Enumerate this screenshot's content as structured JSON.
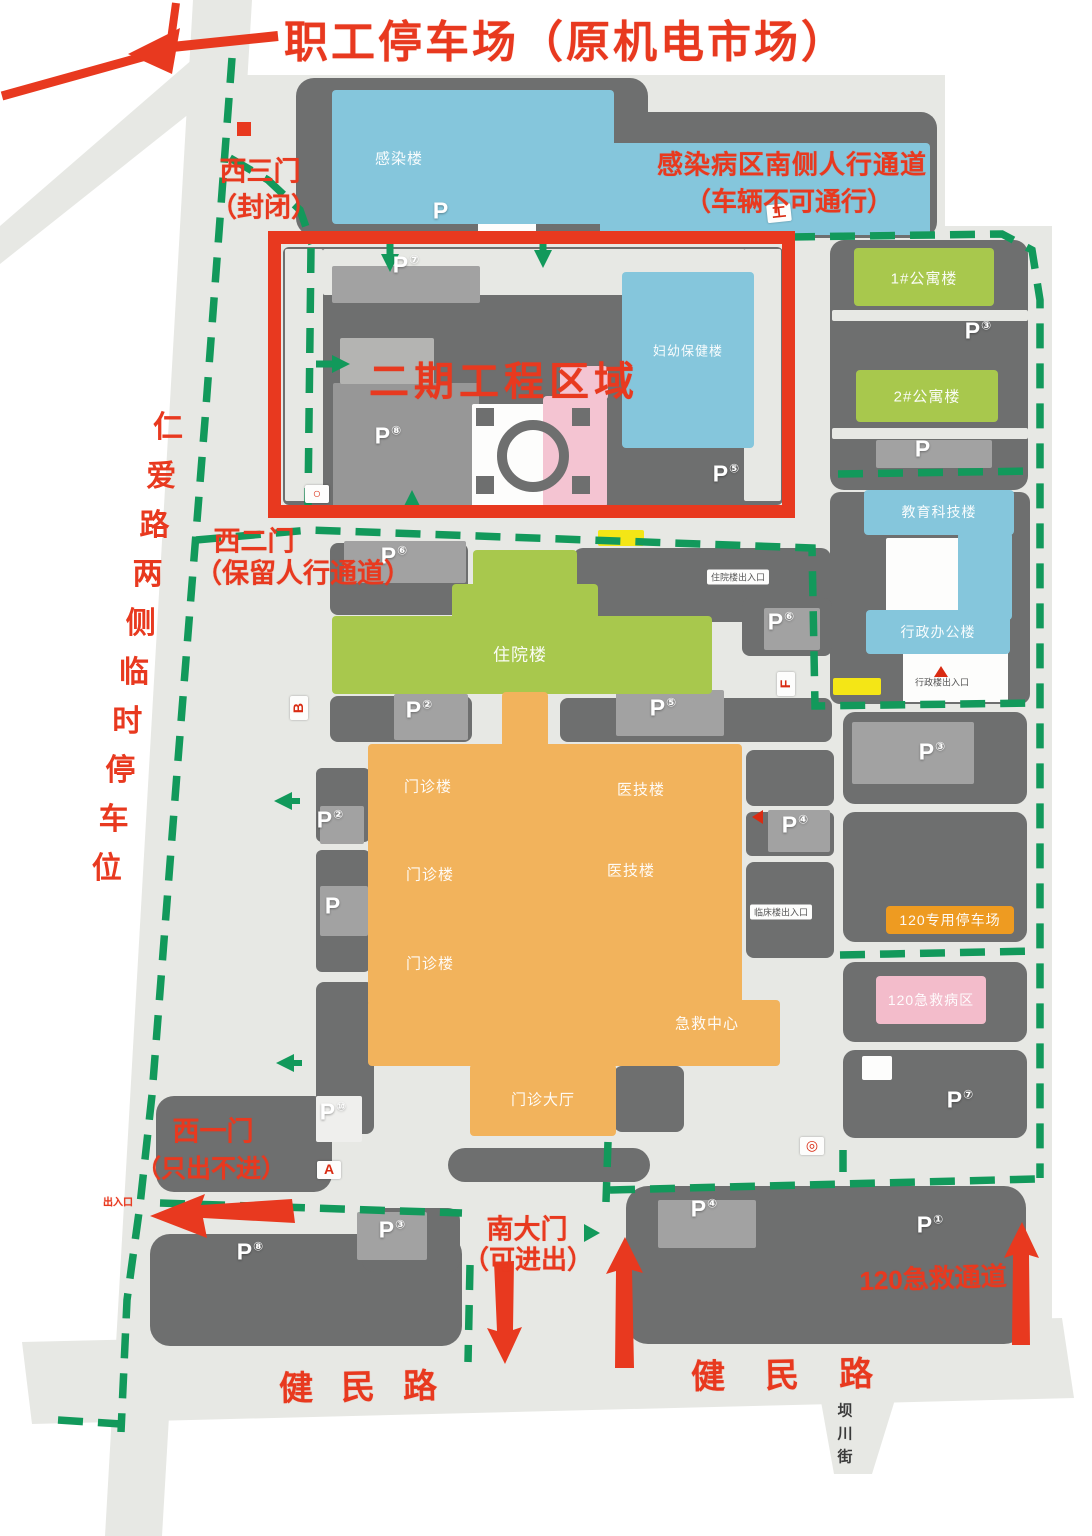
{
  "ui": {
    "parking_letter": "P"
  },
  "colors": {
    "accent_red": "#e8391f",
    "route_green": "#12995b",
    "ground": "#e7e8e4",
    "block": "#6e6f6f",
    "blue": "#85c6dc",
    "green": "#a8c84d",
    "orange": "#f2b35c",
    "pink": "#f4c4d2",
    "pink2": "#f3bccb",
    "banner": "#ee9b21",
    "yellow": "#f4e616"
  },
  "annotations": [
    {
      "id": "staff-parking-title",
      "text": "职工停车场（原机电市场）",
      "x": 566,
      "y": 38,
      "size": 44,
      "ls": 3
    },
    {
      "id": "infection-note-line1",
      "text": "感染病区南侧人行通道",
      "x": 792,
      "y": 163,
      "size": 26,
      "ls": 1
    },
    {
      "id": "infection-note-line2",
      "text": "（车辆不可通行）",
      "x": 789,
      "y": 200,
      "size": 26
    },
    {
      "id": "west-gate-3",
      "text": "西三门",
      "x": 260,
      "y": 169,
      "size": 27
    },
    {
      "id": "west-gate-3-note",
      "text": "（封闭）",
      "x": 264,
      "y": 205,
      "size": 27
    },
    {
      "id": "west-gate-2",
      "text": "西二门",
      "x": 254,
      "y": 539,
      "size": 27
    },
    {
      "id": "west-gate-2-note",
      "text": "（保留人行通道）",
      "x": 303,
      "y": 571,
      "size": 27
    },
    {
      "id": "phase2-zone-label",
      "text": "二期工程区域",
      "x": 504,
      "y": 378,
      "size": 40,
      "ls": 5
    },
    {
      "id": "west-gate-1",
      "text": "西一门",
      "x": 213,
      "y": 1129,
      "size": 27
    },
    {
      "id": "west-gate-1-note",
      "text": "（只出不进）",
      "x": 211,
      "y": 1167,
      "size": 25
    },
    {
      "id": "south-gate",
      "text": "南大门",
      "x": 527,
      "y": 1227,
      "size": 27
    },
    {
      "id": "south-gate-note",
      "text": "（可进出）",
      "x": 528,
      "y": 1258,
      "size": 26
    },
    {
      "id": "emergency-route-label",
      "text": "120急救通道",
      "x": 933,
      "y": 1277,
      "size": 26,
      "rot": -2
    },
    {
      "id": "jianmin-road-west",
      "text": "健民路",
      "x": 372,
      "y": 1384,
      "size": 34,
      "ls": 28,
      "rot": -1
    },
    {
      "id": "jianmin-road-east",
      "text": "健民路",
      "x": 802,
      "y": 1372,
      "size": 34,
      "ls": 40,
      "rot": -1
    },
    {
      "id": "west-gate-1-exit-tiny",
      "text": "出入口",
      "x": 118,
      "y": 1201,
      "size": 10
    }
  ],
  "vertical_labels": [
    {
      "id": "renai-road-parking",
      "text": "仁爱路两侧临时停车位",
      "x": 168,
      "y": 424,
      "dx": -6.8,
      "dy": 49,
      "size": 30,
      "color": "#e8391f"
    },
    {
      "id": "bachuan-street",
      "text": "坝川街",
      "x": 845,
      "y": 1410,
      "dx": 0,
      "dy": 23,
      "size": 15,
      "color": "#3a3a3a"
    }
  ],
  "blocks": [
    [
      296,
      78,
      352,
      158,
      18
    ],
    [
      552,
      112,
      385,
      126,
      16
    ],
    [
      283,
      247,
      500,
      258,
      6
    ],
    [
      830,
      240,
      198,
      250,
      14
    ],
    [
      830,
      492,
      200,
      212,
      10
    ],
    [
      843,
      712,
      184,
      92,
      12
    ],
    [
      843,
      812,
      184,
      130,
      12
    ],
    [
      843,
      962,
      184,
      80,
      12
    ],
    [
      843,
      1050,
      184,
      88,
      12
    ],
    [
      330,
      543,
      138,
      72,
      8
    ],
    [
      573,
      548,
      258,
      74,
      10
    ],
    [
      330,
      696,
      142,
      46,
      8
    ],
    [
      560,
      698,
      272,
      44,
      8
    ],
    [
      742,
      598,
      90,
      58,
      8
    ],
    [
      316,
      768,
      54,
      74,
      6
    ],
    [
      316,
      850,
      54,
      122,
      6
    ],
    [
      316,
      982,
      58,
      152,
      8
    ],
    [
      746,
      750,
      88,
      56,
      8
    ],
    [
      746,
      812,
      88,
      44,
      6
    ],
    [
      746,
      862,
      88,
      96,
      8
    ],
    [
      448,
      1148,
      202,
      34,
      17
    ],
    [
      614,
      1066,
      70,
      66,
      8
    ],
    [
      156,
      1096,
      176,
      96,
      18
    ],
    [
      150,
      1234,
      312,
      112,
      20
    ],
    [
      362,
      1208,
      98,
      64,
      12
    ],
    [
      626,
      1186,
      400,
      158,
      22
    ],
    [
      385,
      798,
      132,
      58,
      4
    ],
    [
      543,
      806,
      26,
      48,
      3
    ],
    [
      612,
      814,
      82,
      36,
      3
    ],
    [
      385,
      884,
      130,
      58,
      4
    ],
    [
      545,
      888,
      24,
      54,
      3
    ],
    [
      618,
      884,
      78,
      40,
      3
    ],
    [
      378,
      974,
      136,
      28,
      3
    ],
    [
      552,
      972,
      110,
      28,
      3
    ]
  ],
  "tiles": [
    [
      "light",
      285,
      249,
      38,
      252
    ],
    [
      "light",
      323,
      249,
      422,
      46
    ],
    [
      "light",
      744,
      249,
      37,
      252
    ],
    [
      "pk",
      332,
      266,
      148,
      37
    ],
    [
      "lot",
      333,
      383,
      146,
      124
    ],
    [
      "pk2",
      340,
      338,
      94,
      46
    ],
    [
      "white",
      472,
      404,
      126,
      104
    ],
    [
      "white",
      478,
      196,
      58,
      44
    ],
    [
      "white",
      757,
      150,
      44,
      56
    ],
    [
      "light",
      832,
      310,
      196,
      11
    ],
    [
      "light",
      832,
      428,
      196,
      11
    ],
    [
      "pk",
      876,
      440,
      116,
      28
    ],
    [
      "white",
      886,
      538,
      78,
      78
    ],
    [
      "white",
      903,
      648,
      105,
      54
    ],
    [
      "pk",
      852,
      722,
      122,
      62
    ],
    [
      "white",
      862,
      1056,
      30,
      24
    ],
    [
      "pk",
      344,
      541,
      122,
      42
    ],
    [
      "pk",
      394,
      694,
      74,
      46
    ],
    [
      "pk",
      616,
      690,
      108,
      46
    ],
    [
      "pk",
      764,
      608,
      56,
      42
    ],
    [
      "pk",
      320,
      806,
      44,
      38
    ],
    [
      "pk",
      320,
      886,
      48,
      50
    ],
    [
      "whiteish",
      316,
      1096,
      46,
      46
    ],
    [
      "pk",
      768,
      810,
      62,
      42
    ],
    [
      "pk",
      658,
      1200,
      98,
      48
    ],
    [
      "pk",
      357,
      1212,
      70,
      48
    ],
    [
      "yellow",
      598,
      530,
      46,
      16
    ],
    [
      "yellow",
      833,
      678,
      48,
      17
    ]
  ],
  "buildings": [
    {
      "id": "infection-building",
      "label": "感染楼",
      "x": 332,
      "y": 90,
      "w": 282,
      "h": 134,
      "color": "blue",
      "lx": 399,
      "ly": 158
    },
    {
      "id": "infection-building-east",
      "label": "",
      "x": 600,
      "y": 143,
      "w": 330,
      "h": 92,
      "color": "blue"
    },
    {
      "id": "phase2-building",
      "label": "妇幼保健楼",
      "x": 622,
      "y": 272,
      "w": 132,
      "h": 176,
      "color": "blue",
      "lx": 688,
      "ly": 350,
      "lsz": 13
    },
    {
      "id": "phase2-pink-annex-a",
      "label": "",
      "x": 560,
      "y": 366,
      "w": 48,
      "h": 34,
      "color": "pink"
    },
    {
      "id": "phase2-pink-annex-b",
      "label": "",
      "x": 543,
      "y": 396,
      "w": 64,
      "h": 112,
      "color": "pink"
    },
    {
      "id": "apartment-1",
      "label": "1#公寓楼",
      "x": 854,
      "y": 248,
      "w": 140,
      "h": 58,
      "color": "green",
      "lx": 924,
      "ly": 278
    },
    {
      "id": "apartment-2",
      "label": "2#公寓楼",
      "x": 856,
      "y": 370,
      "w": 142,
      "h": 52,
      "color": "green",
      "lx": 927,
      "ly": 396
    },
    {
      "id": "education-tech-building",
      "label": "教育科技楼",
      "x": 864,
      "y": 490,
      "w": 150,
      "h": 45,
      "color": "blue",
      "lx": 939,
      "ly": 512,
      "lsz": 14
    },
    {
      "id": "education-tech-wing",
      "label": "",
      "x": 958,
      "y": 532,
      "w": 54,
      "h": 88,
      "color": "blue"
    },
    {
      "id": "admin-office-building",
      "label": "行政办公楼",
      "x": 866,
      "y": 610,
      "w": 144,
      "h": 44,
      "color": "blue",
      "lx": 938,
      "ly": 632,
      "lsz": 14
    },
    {
      "id": "inpatient-building",
      "label": "住院楼",
      "x": 332,
      "y": 616,
      "w": 380,
      "h": 78,
      "color": "green",
      "lx": 520,
      "ly": 653,
      "lsz": 17
    },
    {
      "id": "inpatient-wing-a",
      "label": "",
      "x": 473,
      "y": 550,
      "w": 104,
      "h": 70,
      "color": "green"
    },
    {
      "id": "inpatient-wing-b",
      "label": "",
      "x": 452,
      "y": 584,
      "w": 146,
      "h": 38,
      "color": "green"
    },
    {
      "id": "corridor-stem",
      "label": "",
      "x": 502,
      "y": 692,
      "w": 46,
      "h": 56,
      "color": "orange"
    },
    {
      "id": "outpatient-complex",
      "label": "",
      "x": 368,
      "y": 744,
      "w": 374,
      "h": 262,
      "color": "orange"
    },
    {
      "id": "emergency-band",
      "label": "",
      "x": 368,
      "y": 1000,
      "w": 412,
      "h": 66,
      "color": "orange"
    },
    {
      "id": "outpatient-hall-wing",
      "label": "",
      "x": 470,
      "y": 1064,
      "w": 146,
      "h": 72,
      "color": "orange"
    },
    {
      "id": "ambulance-parking-banner",
      "label": "120专用停车场",
      "x": 886,
      "y": 906,
      "w": 128,
      "h": 28,
      "color": "banner",
      "lx": 950,
      "ly": 920,
      "lsz": 14
    },
    {
      "id": "emergency-ward-120",
      "label": "120急救病区",
      "x": 876,
      "y": 976,
      "w": 110,
      "h": 48,
      "color": "pink2",
      "lx": 931,
      "ly": 1000,
      "lsz": 14
    }
  ],
  "floating_labels": [
    {
      "text": "门诊楼",
      "x": 428,
      "y": 786
    },
    {
      "text": "医技楼",
      "x": 641,
      "y": 789
    },
    {
      "text": "门诊楼",
      "x": 430,
      "y": 874
    },
    {
      "text": "医技楼",
      "x": 631,
      "y": 870
    },
    {
      "text": "门诊楼",
      "x": 430,
      "y": 963
    },
    {
      "text": "急救中心",
      "x": 707,
      "y": 1023
    },
    {
      "text": "门诊大厅",
      "x": 543,
      "y": 1099
    }
  ],
  "parking_icons": [
    {
      "x": 441,
      "y": 211,
      "num": ""
    },
    {
      "x": 406,
      "y": 265,
      "num": "⑦"
    },
    {
      "x": 388,
      "y": 436,
      "num": "⑧"
    },
    {
      "x": 726,
      "y": 474,
      "num": "⑤"
    },
    {
      "x": 978,
      "y": 331,
      "num": "③"
    },
    {
      "x": 923,
      "y": 449,
      "num": ""
    },
    {
      "x": 394,
      "y": 556,
      "num": "⑥"
    },
    {
      "x": 419,
      "y": 710,
      "num": "②"
    },
    {
      "x": 663,
      "y": 708,
      "num": "⑤"
    },
    {
      "x": 781,
      "y": 622,
      "num": "⑥"
    },
    {
      "x": 330,
      "y": 820,
      "num": "②"
    },
    {
      "x": 333,
      "y": 906,
      "num": ""
    },
    {
      "x": 795,
      "y": 825,
      "num": "④"
    },
    {
      "x": 932,
      "y": 752,
      "num": "③"
    },
    {
      "x": 960,
      "y": 1100,
      "num": "⑦"
    },
    {
      "x": 333,
      "y": 1112,
      "num": "⑩"
    },
    {
      "x": 250,
      "y": 1252,
      "num": "⑧"
    },
    {
      "x": 392,
      "y": 1230,
      "num": "③"
    },
    {
      "x": 704,
      "y": 1209,
      "num": "④"
    },
    {
      "x": 930,
      "y": 1225,
      "num": "①"
    }
  ],
  "tags": [
    {
      "text": "工",
      "x": 779,
      "y": 213,
      "rot": -6
    },
    {
      "text": "B",
      "x": 299,
      "y": 708,
      "rot": -90
    },
    {
      "text": "F",
      "x": 786,
      "y": 684,
      "rot": -90
    },
    {
      "text": "A",
      "x": 329,
      "y": 1170,
      "rot": 0
    },
    {
      "text": "◎",
      "x": 812,
      "y": 1146,
      "rot": 0
    },
    {
      "text": "○",
      "x": 317,
      "y": 494,
      "rot": 0
    }
  ],
  "markers": [
    {
      "type": "square",
      "x": 237,
      "y": 122
    },
    {
      "type": "tri-left",
      "x": 752,
      "y": 810
    },
    {
      "type": "tri-up",
      "x": 934,
      "y": 666
    }
  ],
  "tiny_labels": [
    {
      "text": "住院楼出入口",
      "x": 738,
      "y": 577,
      "tile": true
    },
    {
      "text": "行政楼出入口",
      "x": 942,
      "y": 682,
      "tile": false
    },
    {
      "text": "临床楼出入口",
      "x": 781,
      "y": 912,
      "tile": true
    }
  ]
}
